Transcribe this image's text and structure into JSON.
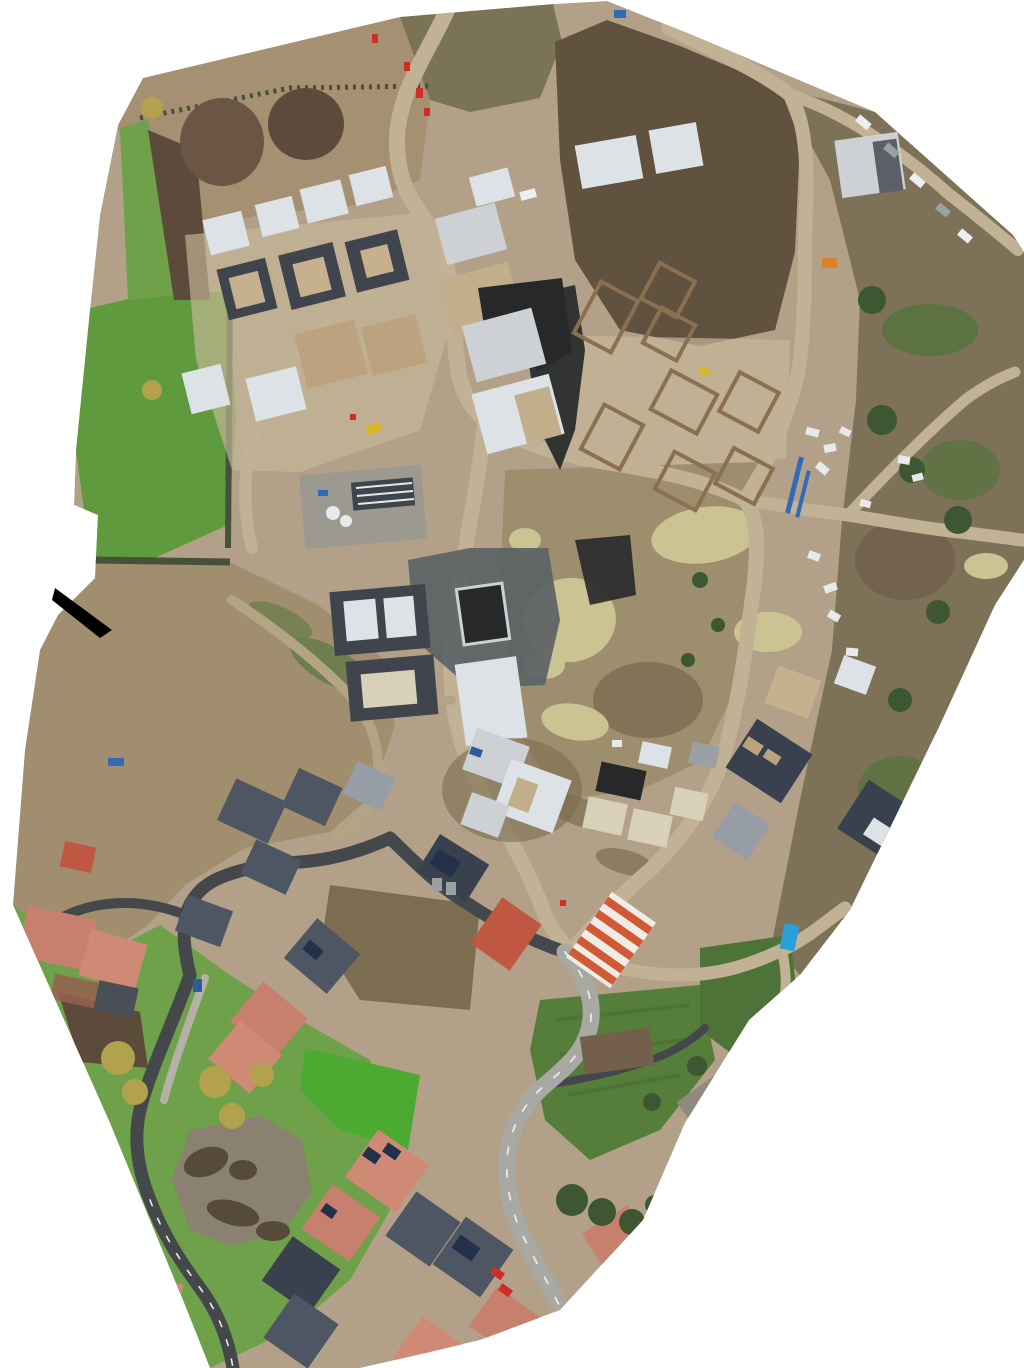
{
  "canvas": {
    "width_px": 1024,
    "height_px": 1368
  },
  "palette": {
    "page_background": "#ffffff",
    "void_black": "#000000",
    "dirt_base": "#b2a188",
    "dirt_light": "#c7b89a",
    "stubble_field": "#a69072",
    "scrub_olive": "#7b7355",
    "ploughed_dark": "#60523f",
    "scrub_left": "#a18e6e",
    "scrub_right": "#7d7158",
    "grass_bright": "#5f9a3e",
    "grass_vivid": "#4caa33",
    "grass_mid": "#6fa04a",
    "grass_dark": "#4e7338",
    "allotment_green": "#567e3b",
    "hedge_dark": "#47503a",
    "trees_dark": "#3d5733",
    "trees_autumn": "#b2a24e",
    "mound_brown": "#6b5646",
    "mound_dark": "#5c4a3a",
    "mud_field": "#9d8e6d",
    "mud_streak": "#7c6c50",
    "puddle_yellow": "#cbc492",
    "pond_water": "#8a8171",
    "pond_reeds": "#564a38",
    "road_dirt": "#c1b296",
    "road_track": "#b3a584",
    "road_asphalt": "#45484b",
    "road_fresh": "#a9a9a3",
    "road_marking": "#eceae2",
    "pavement_gray": "#b5b1a8",
    "work_gray": "#5a6065",
    "compound_gray": "#979892",
    "slab_white": "#dde2e6",
    "scaffold_light": "#cdd1d4",
    "scaffold_tan": "#c2ae8a",
    "membrane_black": "#26282a",
    "foundation_dark": "#40454d",
    "foundation_brick": "#8a7050",
    "brick_pad": "#c7b08d",
    "block_tan": "#bca27e",
    "laydown_pale": "#d9d0b9",
    "roof_slate": "#4d5662",
    "roof_navy": "#39414f",
    "roof_gray": "#979da5",
    "roof_salmon": "#c8806e",
    "roof_salmon_light": "#cf8a76",
    "roof_red": "#bf5742",
    "stripe_orange": "#cf5a35",
    "stripe_white": "#efece6",
    "barn_brown": "#74604a",
    "barn_stone": "#8e8a80",
    "solar_panel": "#22304a",
    "brick_paving": "#96604f",
    "patio_dark": "#4a4e55",
    "vehicle_red": "#cf2d28",
    "vehicle_white": "#eceff1",
    "vehicle_gray": "#9aa0a4",
    "vehicle_orange": "#d9822b",
    "vehicle_blue": "#2e5d9e",
    "machine_yellow": "#d8b62a",
    "container_blue": "#2aa0d8",
    "pipe_blue": "#2f6cb5",
    "stack_white": "#e7e9ea"
  }
}
